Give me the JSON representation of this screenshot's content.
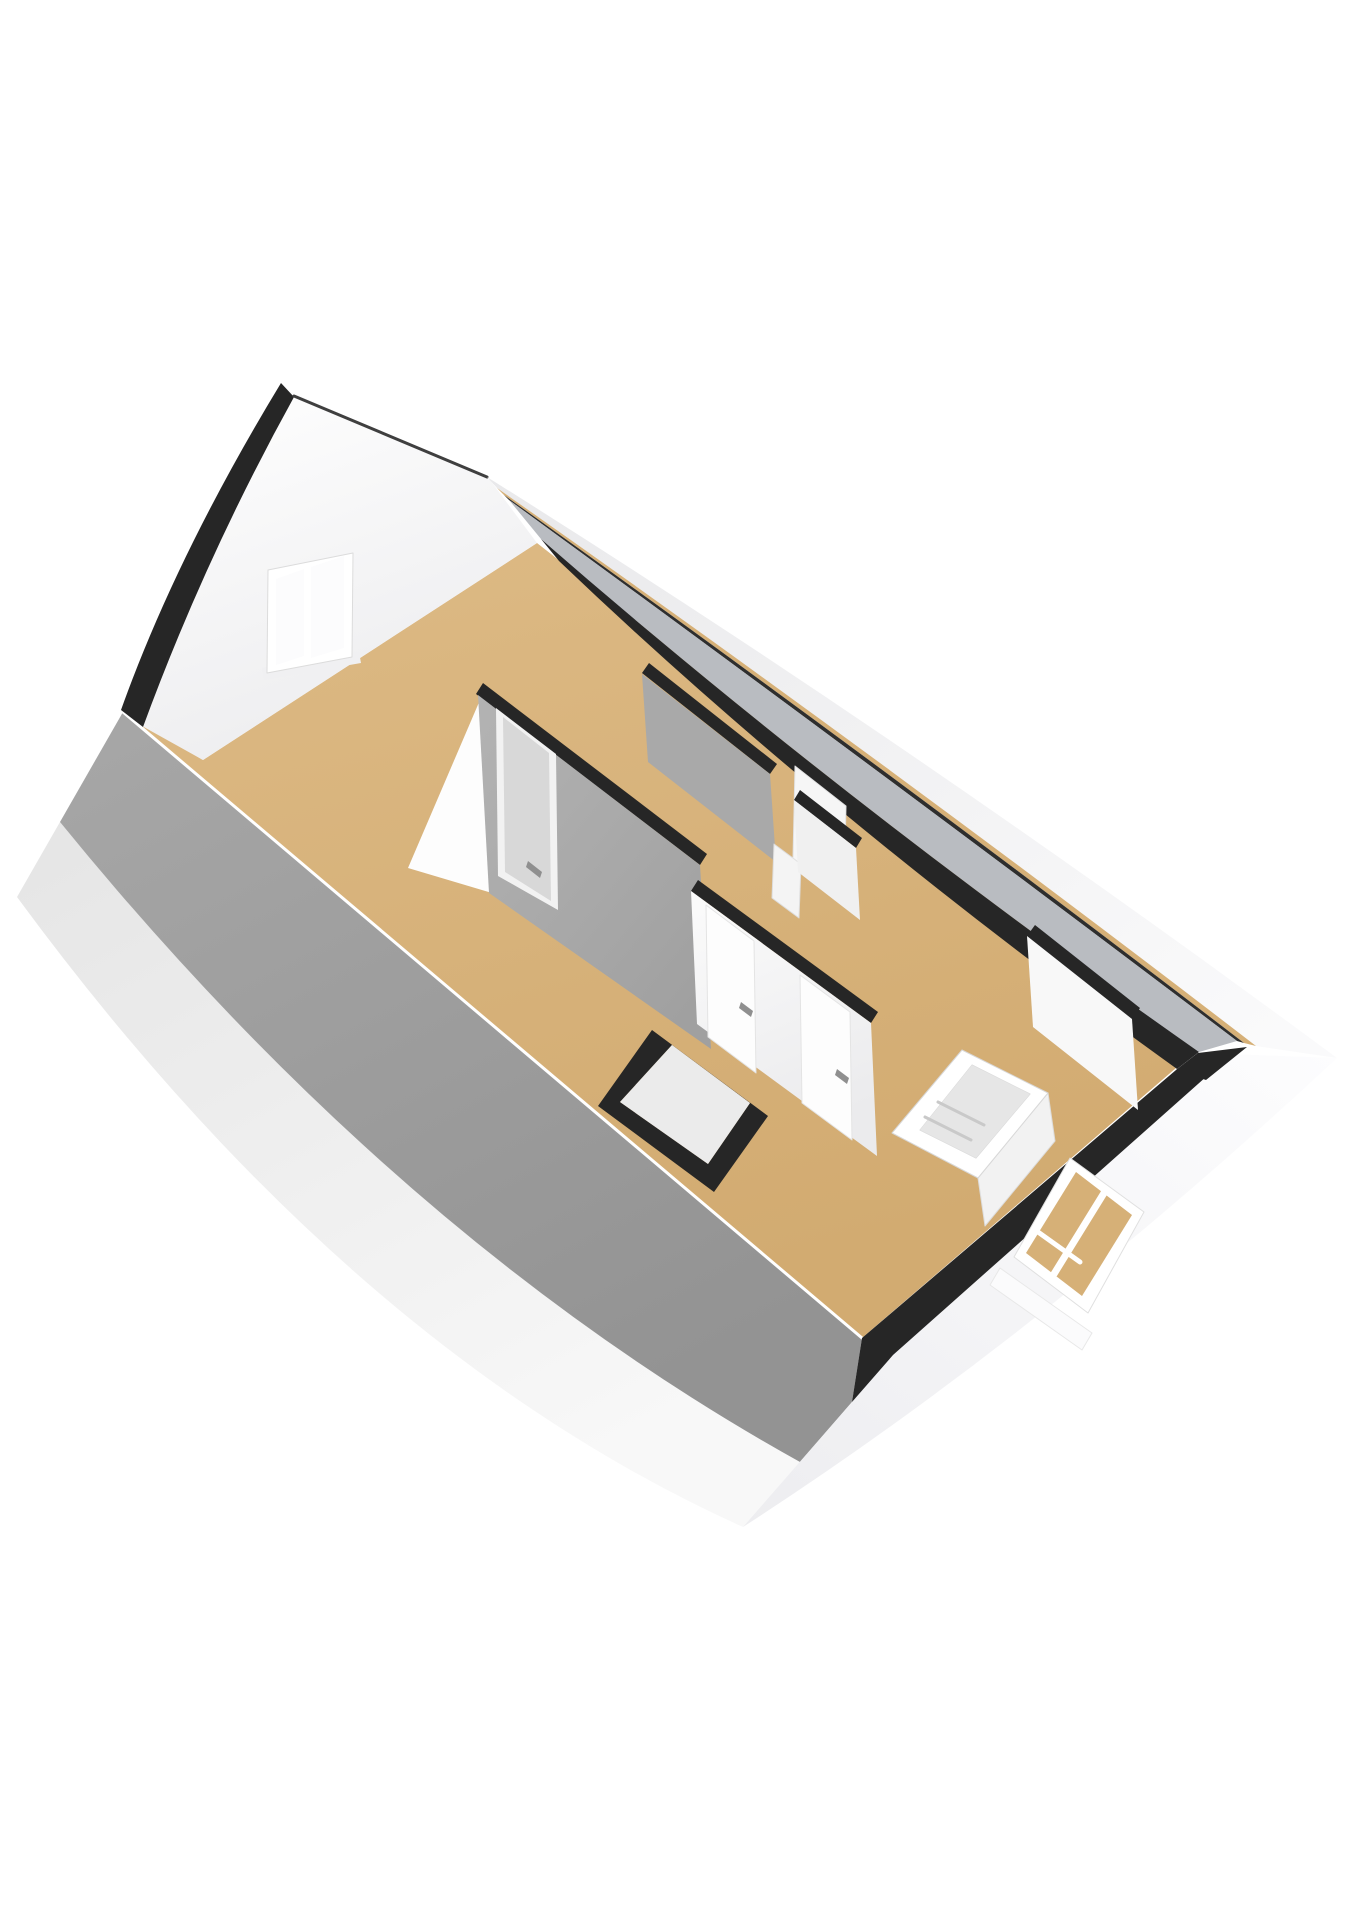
{
  "meta": {
    "image_type": "3d-floor-plan-render",
    "view": "axonometric-attic-storey"
  },
  "palette": {
    "bg": "#ffffff",
    "roof_light": "#a7a7a7",
    "roof_dark": "#939393",
    "skirt_light": "#f8f8f8",
    "skirt_dark": "#e5e5e5",
    "band_light": "#fafafb",
    "band_dark": "#e9e9eb",
    "band2_light": "#fdfdfe",
    "band2_dark": "#ededf0",
    "floor_light": "#ddba85",
    "floor_dark": "#d2ab71",
    "floor_sliver": "#d6b077",
    "gable_light": "#ffffff",
    "gable_dark": "#ededef",
    "cap": "#262626",
    "cap_soft": "#2e2e2e",
    "ridge": "#3f3f3f",
    "line_white": "#ffffff",
    "wall_gray": "#a9a9a9",
    "wall_grayA_light": "#b3b3b3",
    "wall_grayA_dark": "#a0a0a0",
    "wall_gray_light": "#b9bcc1",
    "wall_white": "#f8f8f8",
    "center_light": "#fbfbfb",
    "center_dark": "#ebebed",
    "door_leaf": "#d8d8d8",
    "door_white": "#fdfdfd",
    "handle": "#8f8f8f",
    "glass": "#fcfcfd",
    "frame_white": "#ffffff",
    "railing_inner": "#e6e6e6",
    "closet_inner": "#ebebeb"
  },
  "scene": {
    "width": 1358,
    "height": 1920,
    "elements": [
      "sloped-roof-plane",
      "roof-eave-skirt",
      "attic-floor-plate",
      "gable-wall",
      "gable-window",
      "roof-verge-band",
      "ridge-line",
      "eave-band-top",
      "knee-wall-caps",
      "eave-band-bottom",
      "dormer-window",
      "interior-partition-walls",
      "interior-doors",
      "stair-opening-railing",
      "closet-shaft"
    ],
    "shapes": [
      {
        "name": "roof-eave-skirt",
        "d": "M60,822 Q400,1240 800,1462 L743,1527 Q350,1350 17,897 Z",
        "fill": "url(#g-skirt)"
      },
      {
        "name": "roof-plane",
        "d": "M123,712 L862,1338 L852,1402 L800,1462 Q400,1240 60,822 Z",
        "fill": "url(#g-roof)"
      },
      {
        "name": "floor-plate",
        "points": "203,760 537,543 1190,1056 862,1338 123,712",
        "fill": "url(#g-floor)"
      },
      {
        "name": "roof-cut-edge",
        "d": "M123,712 L862,1338",
        "fill": "none",
        "stroke": "$line_white",
        "w": 3
      },
      {
        "name": "gable-wall",
        "d": "M287,390 L490,480 L537,543 L203,760 L142,726 Q200,552 287,390 Z",
        "fill": "url(#g-gable)"
      },
      {
        "name": "roof-verge-band",
        "d": "M281,383 Q176,556 121,710 L143,727 Q205,558 294,397 Z",
        "fill": "$cap"
      },
      {
        "name": "ridge-line",
        "d": "M294,396 L487,477",
        "fill": "none",
        "stroke": "$ridge",
        "w": 3
      },
      {
        "name": "gable-window-sill",
        "points": "262,668 359,652 361,663 264,680",
        "fill": "#f0f0f2"
      },
      {
        "name": "gable-window-frame",
        "points": "268,570 353,553 352,657 267,673",
        "fill": "$frame_white",
        "stroke": "#dcdcdc",
        "w": 1
      },
      {
        "name": "gable-window-pane-left",
        "points": "276,579 304,569 304,656 276,665",
        "fill": "$glass"
      },
      {
        "name": "gable-window-pane-right",
        "points": "311,567 344,556 344,648 311,658",
        "fill": "$glass"
      },
      {
        "name": "eave-band-top",
        "d": "M487,477 Q910,742 1337,1058 L1256,1046 Q885,760 497,488 Z",
        "fill": "url(#g-band)"
      },
      {
        "name": "eave-floor-sliver",
        "d": "M497,488 Q885,760 1256,1046 L1244,1043 Q880,763 504,495 Z",
        "fill": "$floor_sliver"
      },
      {
        "name": "eave-thin-cap",
        "d": "M504,495 Q880,763 1244,1043 L1237,1041 Q874,766 509,500 Z",
        "fill": "$cap_soft"
      },
      {
        "name": "ceiling-slope-strip",
        "d": "M509,500 Q874,766 1237,1041 L1199,1052 Q840,800 541,539 Z",
        "fill": "$wall_gray_light"
      },
      {
        "name": "knee-wall-cap-top",
        "d": "M541,539 Q840,800 1199,1052 L1177,1069 Q828,818 559,561 Z",
        "fill": "$cap"
      },
      {
        "name": "eave-band-bottom",
        "d": "M743,1527 Q1040,1335 1337,1058 L1198,1053 L890,1330 L852,1402 Z",
        "fill": "url(#g-band2)"
      },
      {
        "name": "knee-wall-cap-bottom",
        "d": "M852,1402 L862,1338 L1176,1070 L1198,1053 L1216,1068 L893,1355 Z",
        "fill": "$cap"
      },
      {
        "name": "corner-cap-wedge",
        "points": "1176,1070 1198,1053 1247,1047 1206,1080",
        "fill": "$cap"
      },
      {
        "name": "wall-end-face",
        "points": "408,868 486,686 492,893",
        "fill": "#fdfdfd"
      },
      {
        "name": "wall-a-cap",
        "points": "483,683 707,854 700,865 476,694",
        "fill": "$cap"
      },
      {
        "name": "wall-a-face",
        "points": "478,695 700,865 711,1049 489,893",
        "fill": "url(#g-wallA)"
      },
      {
        "name": "door-a-frame",
        "points": "496,708 556,754 558,910 498,876",
        "fill": "#f2f2f2"
      },
      {
        "name": "door-a-leaf",
        "points": "503,717 549,753 551,901 505,872",
        "fill": "$door_leaf"
      },
      {
        "name": "door-a-handle",
        "points": "528,861 542,872 540,878 526,867",
        "fill": "$handle"
      },
      {
        "name": "wall-b-cap",
        "points": "649,663 777,764 770,774 642,673",
        "fill": "$cap"
      },
      {
        "name": "wall-b-face",
        "points": "642,674 770,774 776,862 648,762",
        "fill": "$wall_gray"
      },
      {
        "name": "corridor-open-door",
        "points": "774,844 801,864 799,918 772,898",
        "fill": "#f4f4f4",
        "stroke": "#dddddd",
        "w": 1
      },
      {
        "name": "knee-door-panel",
        "points": "795,766 846,806 844,898 793,858",
        "fill": "#f6f6f6",
        "stroke": "#e2e2e2",
        "w": 1
      },
      {
        "name": "partition-c-cap",
        "points": "800,790 862,838 856,848 794,800",
        "fill": "$cap"
      },
      {
        "name": "partition-c-face",
        "points": "794,800 856,848 860,920 798,872",
        "fill": "#f0f0f0"
      },
      {
        "name": "center-wall-cap",
        "points": "698,880 878,1012 871,1023 691,891",
        "fill": "$cap"
      },
      {
        "name": "center-wall-face",
        "points": "691,891 871,1023 877,1156 697,1024",
        "fill": "url(#g-center)"
      },
      {
        "name": "door-1-leaf",
        "points": "706,905 754,941 756,1073 708,1037",
        "fill": "$door_white",
        "stroke": "#e4e4e4",
        "w": 1
      },
      {
        "name": "door-1-handle",
        "points": "741,1002 753,1011 751,1017 739,1008",
        "fill": "$handle"
      },
      {
        "name": "door-2-leaf",
        "points": "800,975 850,1012 852,1140 802,1103",
        "fill": "$door_white",
        "stroke": "#e4e4e4",
        "w": 1
      },
      {
        "name": "door-2-handle",
        "points": "837,1069 849,1078 847,1084 835,1075",
        "fill": "$handle"
      },
      {
        "name": "closet-cap-outline",
        "d": "M652,1030 L768,1116 L714,1192 L598,1106 Z M672,1045 L750,1103 L708,1164 L620,1102 Z",
        "fill": "$cap",
        "rule": "evenodd"
      },
      {
        "name": "closet-inner",
        "points": "672,1045 750,1103 708,1164 620,1102",
        "fill": "$closet_inner"
      },
      {
        "name": "right-room-cap",
        "points": "1035,925 1140,1008 1132,1019 1027,936",
        "fill": "$cap"
      },
      {
        "name": "right-room-face",
        "points": "1027,936 1132,1019 1138,1110 1033,1027",
        "fill": "$wall_white"
      },
      {
        "name": "dormer-window-frame",
        "points": "1014,1257 1070,1158 1144,1212 1088,1313",
        "fill": "$frame_white",
        "stroke": "#e0e0e0",
        "w": 1
      },
      {
        "name": "dormer-window-glass",
        "points": "1026,1253 1076,1172 1132,1215 1082,1296",
        "fill": "$floor_sliver"
      },
      {
        "name": "dormer-mullion",
        "d": "M1104,1193 L1054,1274",
        "fill": "none",
        "stroke": "$frame_white",
        "w": 7
      },
      {
        "name": "dormer-bar",
        "d": "M1038,1232 L1080,1262",
        "fill": "none",
        "stroke": "$frame_white",
        "w": 5
      },
      {
        "name": "dormer-sill",
        "points": "1000,1268 1092,1333 1082,1350 990,1285",
        "fill": "#fbfbfc",
        "stroke": "#e8e8e8",
        "w": 1
      },
      {
        "name": "railing-side-panel",
        "points": "1048,1093 1055,1141 985,1226 978,1178",
        "fill": "#f2f2f2",
        "stroke": "#dddddd",
        "w": 1
      },
      {
        "name": "stair-railing-frame",
        "d": "M962,1050 L1048,1093 L978,1178 L892,1133 Z M972,1065 L1030,1094 L976,1158 L920,1130 Z",
        "fill": "$frame_white",
        "rule": "evenodd",
        "stroke": "#d8d8d8",
        "w": 1
      },
      {
        "name": "stair-opening",
        "points": "972,1065 1030,1094 976,1158 920,1130",
        "fill": "$railing_inner"
      },
      {
        "name": "stair-step-1",
        "d": "M938,1102 L984,1125",
        "fill": "none",
        "stroke": "#c9c9c9",
        "w": 3
      },
      {
        "name": "stair-step-2",
        "d": "M925,1117 L971,1140",
        "fill": "none",
        "stroke": "#c9c9c9",
        "w": 3
      }
    ]
  }
}
